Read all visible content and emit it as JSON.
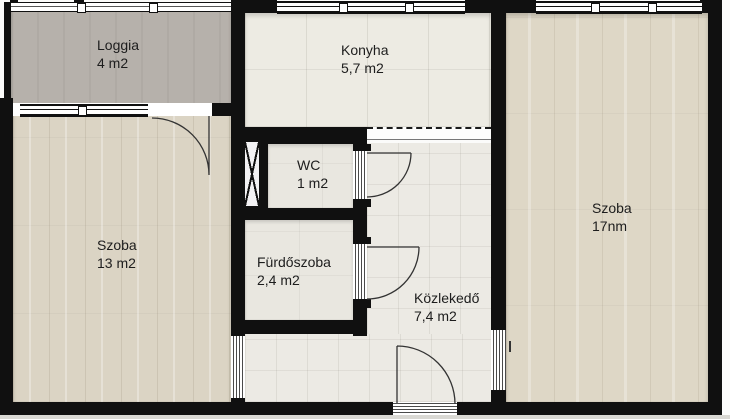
{
  "title": "Apartment floor plan",
  "colors": {
    "wall": "#101010",
    "loggia_floor": "#b6b1ab",
    "wood_floor_left": "#dbd4c4",
    "wood_floor_right": "#ded7c6",
    "tile_floor": "#edebe3",
    "background": "#fbfbfa"
  },
  "rooms": [
    {
      "key": "loggia",
      "name": "Loggia",
      "area": "4 m2"
    },
    {
      "key": "konyha",
      "name": "Konyha",
      "area": "5,7 m2"
    },
    {
      "key": "wc",
      "name": "WC",
      "area": "1 m2"
    },
    {
      "key": "szoba_left",
      "name": "Szoba",
      "area": "13 m2"
    },
    {
      "key": "furdoszoba",
      "name": "Fürdőszoba",
      "area": "2,4 m2"
    },
    {
      "key": "kozlekedo",
      "name": "Közlekedő",
      "area": "7,4 m2"
    },
    {
      "key": "szoba_right",
      "name": "Szoba",
      "area": "17nm"
    }
  ]
}
